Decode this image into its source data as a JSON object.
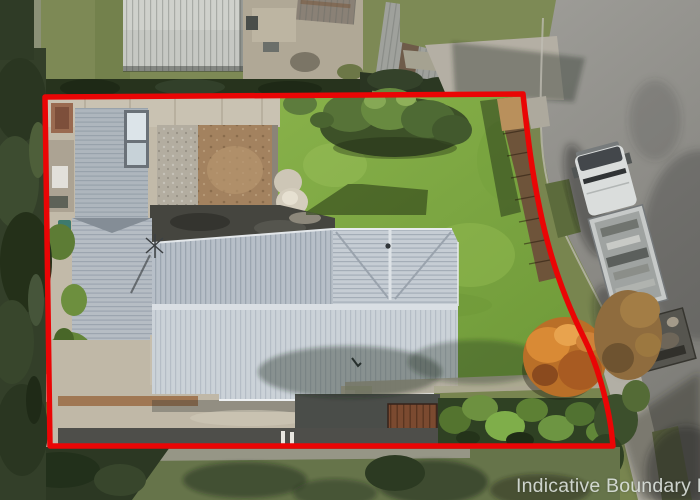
{
  "overlay": {
    "boundary_label": "Indicative Boundary Lin",
    "boundary_color": "#ea0505"
  },
  "palette": {
    "lawn_green": "#82ab45",
    "roof_metal": "#c9d0d7",
    "road_asphalt": "#8d8c87",
    "trees_dark": "#313d27",
    "concrete": "#c2baa9",
    "label_gray": "#e1e7e3"
  }
}
